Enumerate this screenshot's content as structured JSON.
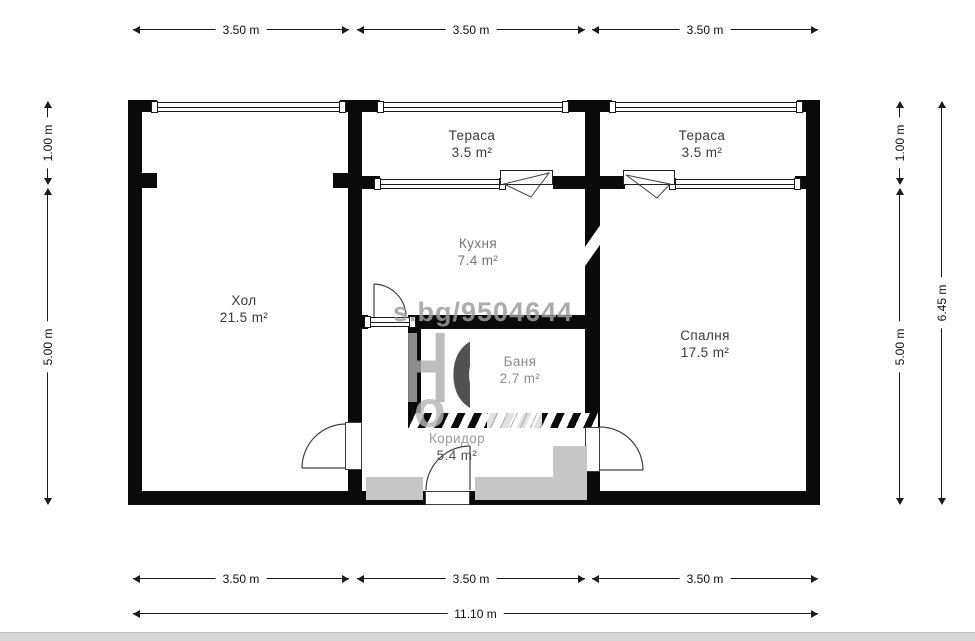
{
  "plan": {
    "rooms": [
      {
        "id": "terrace-1",
        "name": "Тераса",
        "area": "3.5 m²"
      },
      {
        "id": "terrace-2",
        "name": "Тераса",
        "area": "3.5 m²"
      },
      {
        "id": "hall",
        "name": "Хол",
        "area": "21.5 m²"
      },
      {
        "id": "kitchen",
        "name": "Кухня",
        "area": "7.4 m²"
      },
      {
        "id": "bathroom",
        "name": "Баня",
        "area": "2.7 m²"
      },
      {
        "id": "corridor",
        "name": "Коридор",
        "area": "5.4 m²"
      },
      {
        "id": "bedroom",
        "name": "Спалня",
        "area": "17.5 m²"
      }
    ],
    "dimensions": {
      "top": [
        "3.50 m",
        "3.50 m",
        "3.50 m"
      ],
      "bottom": [
        "3.50 m",
        "3.50 m",
        "3.50 m"
      ],
      "bottom_total": "11.10 m",
      "left": [
        "1.00 m",
        "5.00 m"
      ],
      "right": [
        "1.00 m",
        "5.00 m"
      ],
      "right_total": "6.45 m"
    },
    "watermark": {
      "url_text": "s.bg/9504644",
      "letter_h": "Н",
      "letter_o": "О",
      "letter_o_small": "о"
    },
    "colors": {
      "wall": "#0a0a0a",
      "label_dark": "#3a3a3a",
      "label_muted": "#8d8d8d",
      "watermark_gray": "#c6c6c6"
    }
  }
}
